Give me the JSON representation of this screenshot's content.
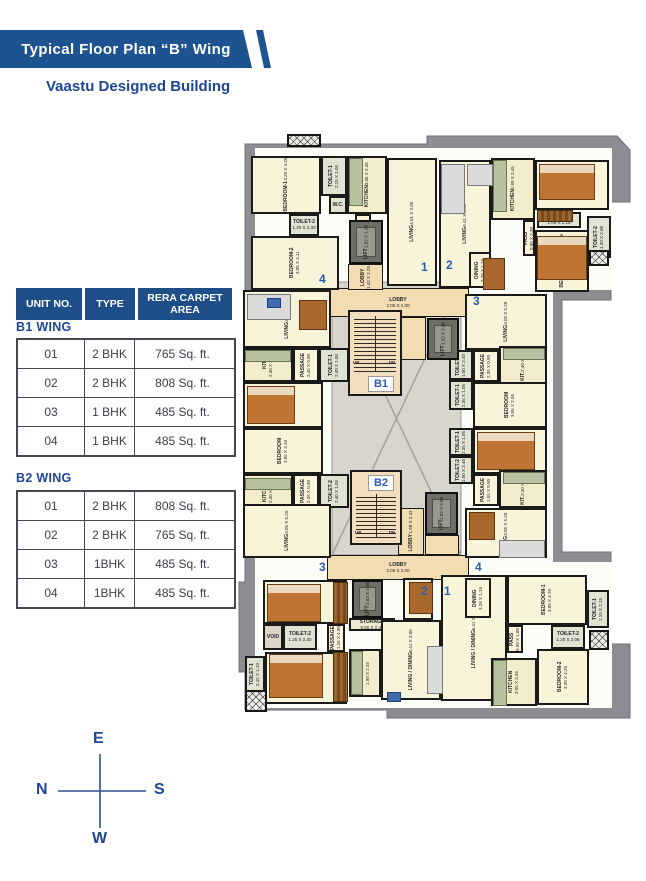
{
  "header": {
    "title": "Typical Floor Plan “B” Wing",
    "subtitle": "Vaastu Designed Building"
  },
  "table": {
    "columns": [
      "UNIT NO.",
      "TYPE",
      "RERA CARPET AREA"
    ],
    "sections": [
      {
        "name": "B1 WING",
        "rows": [
          [
            "01",
            "2 BHK",
            "765 Sq. ft."
          ],
          [
            "02",
            "2 BHK",
            "808 Sq. ft."
          ],
          [
            "03",
            "1 BHK",
            "485 Sq. ft."
          ],
          [
            "04",
            "1 BHK",
            "485 Sq. ft."
          ]
        ]
      },
      {
        "name": "B2 WING",
        "rows": [
          [
            "01",
            "2 BHK",
            "808 Sq. ft."
          ],
          [
            "02",
            "2 BHK",
            "765 Sq. ft."
          ],
          [
            "03",
            "1BHK",
            "485 Sq. ft."
          ],
          [
            "04",
            "1BHK",
            "485 Sq. ft."
          ]
        ]
      }
    ]
  },
  "compass": {
    "top": "E",
    "left": "N",
    "right": "S",
    "bottom": "W"
  },
  "colors": {
    "brand_blue": "#1d5391",
    "accent_blue": "#2a5db0",
    "wall": "#1a1a1a",
    "footprint_gray": "#8d8d92"
  },
  "plan": {
    "rooms": [
      {
        "n": "BEDROOM-1",
        "d": "3.20 X 4.25",
        "x": 14,
        "y": 24,
        "w": 70,
        "h": 58,
        "v": 1,
        "k": ""
      },
      {
        "n": "TOILET-1",
        "d": "2.15 X 1.05",
        "x": 84,
        "y": 24,
        "w": 26,
        "h": 40,
        "v": 1,
        "k": "toilet"
      },
      {
        "n": "KITCHEN",
        "d": "3.05 X 2.45",
        "x": 110,
        "y": 24,
        "w": 40,
        "h": 58,
        "v": 1,
        "k": "kitchen"
      },
      {
        "n": "W.C.",
        "d": "",
        "x": 92,
        "y": 64,
        "w": 18,
        "h": 18,
        "v": 0,
        "k": "toilet"
      },
      {
        "n": "TOILET-2",
        "d": "1.25 X 2.30",
        "x": 52,
        "y": 82,
        "w": 30,
        "h": 22,
        "v": 0,
        "k": "toilet"
      },
      {
        "n": "PASS",
        "d": "0.90 X 2.75",
        "x": 118,
        "y": 82,
        "w": 16,
        "h": 50,
        "v": 1,
        "k": ""
      },
      {
        "n": "BEDROOM-2",
        "d": "3.05 X 4.11",
        "x": 14,
        "y": 104,
        "w": 88,
        "h": 54,
        "v": 1,
        "k": ""
      },
      {
        "n": "LIVING",
        "d": "4.01 X 3.05",
        "x": 150,
        "y": 26,
        "w": 50,
        "h": 128,
        "v": 1,
        "k": ""
      },
      {
        "n": "LIVING",
        "d": "6.41 X 3.05",
        "x": 202,
        "y": 28,
        "w": 52,
        "h": 128,
        "v": 1,
        "k": ""
      },
      {
        "n": "KITCHEN",
        "d": "1.89 X 2.45",
        "x": 254,
        "y": 26,
        "w": 44,
        "h": 62,
        "v": 1,
        "k": "kitchen"
      },
      {
        "n": "BEDROOM-2",
        "d": "3.05 X 4.11",
        "x": 298,
        "y": 28,
        "w": 74,
        "h": 50,
        "v": 1,
        "k": ""
      },
      {
        "n": "PASS",
        "d": "0.90 X 2.30",
        "x": 286,
        "y": 88,
        "w": 12,
        "h": 36,
        "v": 1,
        "k": ""
      },
      {
        "n": "TOILET-1",
        "d": "1.05 X 2.15",
        "x": 300,
        "y": 80,
        "w": 44,
        "h": 16,
        "v": 0,
        "k": "toilet"
      },
      {
        "n": "BEDROOM-1",
        "d": "3.05 X 4.76",
        "x": 298,
        "y": 98,
        "w": 54,
        "h": 62,
        "v": 1,
        "k": ""
      },
      {
        "n": "TOILET-2",
        "d": "1.20 X 2.06",
        "x": 350,
        "y": 84,
        "w": 24,
        "h": 42,
        "v": 1,
        "k": "toilet"
      },
      {
        "n": "DINING",
        "d": "3.28 X 1.19",
        "x": 232,
        "y": 120,
        "w": 22,
        "h": 36,
        "v": 1,
        "k": ""
      },
      {
        "n": "LIVING",
        "d": "3.05 X 5.20",
        "x": 6,
        "y": 158,
        "w": 88,
        "h": 58,
        "v": 1,
        "k": ""
      },
      {
        "n": "KIT.",
        "d": "2.40 X 3.05",
        "x": 6,
        "y": 216,
        "w": 50,
        "h": 34,
        "v": 1,
        "k": "kitchen"
      },
      {
        "n": "PASSAGE",
        "d": "2.45 X 0.90",
        "x": 56,
        "y": 216,
        "w": 26,
        "h": 34,
        "v": 1,
        "k": ""
      },
      {
        "n": "TOILET-1",
        "d": "2.40 X 1.00",
        "x": 82,
        "y": 216,
        "w": 30,
        "h": 34,
        "v": 1,
        "k": "toilet"
      },
      {
        "n": "BEDROOM",
        "d": "3.05 X 3.00",
        "x": 6,
        "y": 250,
        "w": 80,
        "h": 46,
        "v": 1,
        "k": ""
      },
      {
        "n": "BEDROOM",
        "d": "3.05 X 3.10",
        "x": 6,
        "y": 296,
        "w": 80,
        "h": 46,
        "v": 1,
        "k": ""
      },
      {
        "n": "KITCHEN",
        "d": "2.40 X 2.90",
        "x": 6,
        "y": 342,
        "w": 50,
        "h": 34,
        "v": 1,
        "k": "kitchen"
      },
      {
        "n": "PASSAGE",
        "d": "2.35 X 0.90",
        "x": 56,
        "y": 342,
        "w": 26,
        "h": 34,
        "v": 1,
        "k": ""
      },
      {
        "n": "TOILET-2",
        "d": "2.40 X 1.05",
        "x": 82,
        "y": 342,
        "w": 30,
        "h": 34,
        "v": 1,
        "k": "toilet"
      },
      {
        "n": "LIVING",
        "d": "3.05 X 5.20",
        "x": 6,
        "y": 372,
        "w": 88,
        "h": 54,
        "v": 1,
        "k": ""
      },
      {
        "n": "LIVING",
        "d": "3.05 X 5.28",
        "x": 228,
        "y": 162,
        "w": 82,
        "h": 56,
        "v": 1,
        "k": ""
      },
      {
        "n": "TOILET-2",
        "d": "1.00 X 2.40",
        "x": 212,
        "y": 218,
        "w": 24,
        "h": 30,
        "v": 1,
        "k": "toilet"
      },
      {
        "n": "PASSAGE",
        "d": "2.35 X 0.90",
        "x": 236,
        "y": 218,
        "w": 26,
        "h": 32,
        "v": 1,
        "k": ""
      },
      {
        "n": "KIT.",
        "d": "2.40 X 3.05",
        "x": 262,
        "y": 214,
        "w": 48,
        "h": 38,
        "v": 1,
        "k": "kitchen"
      },
      {
        "n": "TOILET-1",
        "d": "2.35 X 1.05",
        "x": 212,
        "y": 248,
        "w": 24,
        "h": 30,
        "v": 1,
        "k": "toilet"
      },
      {
        "n": "BEDROOM",
        "d": "3.05 X 2.95",
        "x": 236,
        "y": 250,
        "w": 74,
        "h": 46,
        "v": 1,
        "k": ""
      },
      {
        "n": "TOILET-1",
        "d": "2.35 X 1.05",
        "x": 212,
        "y": 296,
        "w": 24,
        "h": 28,
        "v": 1,
        "k": "toilet"
      },
      {
        "n": "BEDROOM",
        "d": "3.05 X 2.95",
        "x": 236,
        "y": 296,
        "w": 74,
        "h": 46,
        "v": 1,
        "k": ""
      },
      {
        "n": "TOILET-2",
        "d": "1.00 X 2.40",
        "x": 212,
        "y": 324,
        "w": 24,
        "h": 28,
        "v": 1,
        "k": "toilet"
      },
      {
        "n": "PASSAGE",
        "d": "1.55 X 0.90",
        "x": 236,
        "y": 342,
        "w": 26,
        "h": 32,
        "v": 1,
        "k": ""
      },
      {
        "n": "KIT.",
        "d": "2.40 X 3.40",
        "x": 262,
        "y": 338,
        "w": 48,
        "h": 38,
        "v": 1,
        "k": "kitchen"
      },
      {
        "n": "LIVING",
        "d": "3.05 X 5.28",
        "x": 228,
        "y": 376,
        "w": 82,
        "h": 50,
        "v": 1,
        "k": ""
      },
      {
        "n": "BEDROOM-2",
        "d": "3.05 X 4.10",
        "x": 26,
        "y": 448,
        "w": 84,
        "h": 44,
        "v": 1,
        "k": ""
      },
      {
        "n": "VOID",
        "d": "",
        "x": 26,
        "y": 492,
        "w": 20,
        "h": 26,
        "v": 0,
        "k": "voidroom"
      },
      {
        "n": "TOILET-2",
        "d": "1.25 X 2.30",
        "x": 46,
        "y": 492,
        "w": 34,
        "h": 26,
        "v": 0,
        "k": "toilet"
      },
      {
        "n": "PASSAGE",
        "d": "1.25 X 4.90",
        "x": 90,
        "y": 492,
        "w": 18,
        "h": 28,
        "v": 1,
        "k": ""
      },
      {
        "n": "BEDROOM-1",
        "d": "3.20 X 4.25",
        "x": 28,
        "y": 520,
        "w": 82,
        "h": 52,
        "v": 1,
        "k": ""
      },
      {
        "n": "TOILET-1",
        "d": "2.15 X 1.10",
        "x": 8,
        "y": 524,
        "w": 20,
        "h": 36,
        "v": 1,
        "k": "toilet"
      },
      {
        "n": "STORAGE",
        "d": "0.55 X 2.45",
        "x": 112,
        "y": 486,
        "w": 46,
        "h": 13,
        "v": 0,
        "k": "storage"
      },
      {
        "n": "KITCHEN",
        "d": "1.90 X 2.45",
        "x": 112,
        "y": 517,
        "w": 32,
        "h": 48,
        "v": 1,
        "k": "kitchen"
      },
      {
        "n": "DINING",
        "d": "3.28 X 1.10",
        "x": 166,
        "y": 446,
        "w": 30,
        "h": 42,
        "v": 1,
        "k": ""
      },
      {
        "n": "LIVING / DINING",
        "d": "6.41 X 3.05",
        "x": 144,
        "y": 488,
        "w": 60,
        "h": 80,
        "v": 1,
        "k": ""
      },
      {
        "n": "LIVING / DINING",
        "d": "6.41 X 3.05",
        "x": 204,
        "y": 443,
        "w": 66,
        "h": 126,
        "v": 1,
        "k": ""
      },
      {
        "n": "DINING",
        "d": "3.28 X 1.19",
        "x": 228,
        "y": 446,
        "w": 26,
        "h": 40,
        "v": 1,
        "k": ""
      },
      {
        "n": "BEDROOM-1",
        "d": "3.05 X 4.70",
        "x": 270,
        "y": 443,
        "w": 80,
        "h": 50,
        "v": 1,
        "k": ""
      },
      {
        "n": "TOILET-1",
        "d": "1.10 X 2.15",
        "x": 350,
        "y": 458,
        "w": 22,
        "h": 38,
        "v": 1,
        "k": "toilet"
      },
      {
        "n": "TOILET-2",
        "d": "1.20 X 2.06",
        "x": 314,
        "y": 493,
        "w": 34,
        "h": 24,
        "v": 0,
        "k": "toilet"
      },
      {
        "n": "PASS",
        "d": "0.90 X 1.85",
        "x": 270,
        "y": 493,
        "w": 16,
        "h": 28,
        "v": 1,
        "k": ""
      },
      {
        "n": "KITCHEN",
        "d": "3.05 X 2.45",
        "x": 254,
        "y": 526,
        "w": 46,
        "h": 48,
        "v": 1,
        "k": "kitchen"
      },
      {
        "n": "BEDROOM-2",
        "d": "3.20 X 4.25",
        "x": 300,
        "y": 517,
        "w": 52,
        "h": 56,
        "v": 1,
        "k": ""
      }
    ],
    "lobbies": [
      {
        "n": "LOBBY",
        "d": "2.06 X 2.00",
        "x": 90,
        "y": 156,
        "w": 142,
        "h": 29,
        "v": 0
      },
      {
        "n": "LOBBY",
        "d": "1.42 X 2.29",
        "x": 111,
        "y": 132,
        "w": 35,
        "h": 26,
        "v": 1
      },
      {
        "n": "",
        "d": "",
        "x": 161,
        "y": 185,
        "w": 28,
        "h": 43,
        "v": 0
      },
      {
        "n": "LOBBY",
        "d": "1.98 X 2.43",
        "x": 161,
        "y": 376,
        "w": 26,
        "h": 47,
        "v": 1
      },
      {
        "n": "",
        "d": "",
        "x": 188,
        "y": 403,
        "w": 34,
        "h": 20,
        "v": 0
      },
      {
        "n": "LOBBY",
        "d": "2.06 X 2.00",
        "x": 90,
        "y": 423,
        "w": 142,
        "h": 25,
        "v": 0
      }
    ],
    "lifts": [
      {
        "n": "LIFT",
        "d": "1.82 X 1.98",
        "x": 112,
        "y": 88,
        "w": 34,
        "h": 44
      },
      {
        "n": "LIFT",
        "d": "1.92 X 2.06",
        "x": 190,
        "y": 186,
        "w": 32,
        "h": 42
      },
      {
        "n": "LIFT",
        "d": "1.92 X 2.06",
        "x": 188,
        "y": 360,
        "w": 33,
        "h": 43
      },
      {
        "n": "LIFT",
        "d": "2.03 X 2.06",
        "x": 115,
        "y": 448,
        "w": 31,
        "h": 38
      }
    ],
    "stairs": [
      {
        "x": 111,
        "y": 178,
        "w": 54,
        "h": 86,
        "steps_top": 4,
        "steps_h": 56,
        "chip": "B1",
        "cx": 131,
        "cy": 244,
        "up": "UP",
        "dn": "DN",
        "ux": 116,
        "uy": 228,
        "dx": 146,
        "dy": 228
      },
      {
        "x": 113,
        "y": 338,
        "w": 52,
        "h": 75,
        "steps_top": 22,
        "steps_h": 44,
        "chip": "B2",
        "cx": 131,
        "cy": 343,
        "up": "UP",
        "dn": "DN",
        "ux": 118,
        "uy": 398,
        "dx": 146,
        "dy": 398
      }
    ],
    "markers": [
      {
        "t": "1",
        "x": 184,
        "y": 128
      },
      {
        "t": "2",
        "x": 209,
        "y": 126
      },
      {
        "t": "4",
        "x": 82,
        "y": 140
      },
      {
        "t": "3",
        "x": 236,
        "y": 162
      },
      {
        "t": "3",
        "x": 82,
        "y": 428
      },
      {
        "t": "4",
        "x": 238,
        "y": 428
      },
      {
        "t": "2",
        "x": 184,
        "y": 452
      },
      {
        "t": "1",
        "x": 207,
        "y": 452
      }
    ],
    "furniture": [
      {
        "k": "bed",
        "x": 302,
        "y": 32,
        "w": 54,
        "h": 34
      },
      {
        "k": "bed",
        "x": 300,
        "y": 104,
        "w": 48,
        "h": 42
      },
      {
        "k": "bed",
        "x": 10,
        "y": 254,
        "w": 46,
        "h": 36
      },
      {
        "k": "bed",
        "x": 240,
        "y": 300,
        "w": 56,
        "h": 36
      },
      {
        "k": "bed",
        "x": 30,
        "y": 452,
        "w": 52,
        "h": 36
      },
      {
        "k": "bed",
        "x": 32,
        "y": 522,
        "w": 52,
        "h": 42
      },
      {
        "k": "sofa",
        "x": 204,
        "y": 32,
        "w": 22,
        "h": 48
      },
      {
        "k": "sofa",
        "x": 230,
        "y": 32,
        "w": 24,
        "h": 20
      },
      {
        "k": "sofa",
        "x": 10,
        "y": 162,
        "w": 42,
        "h": 24
      },
      {
        "k": "sofa",
        "x": 262,
        "y": 408,
        "w": 44,
        "h": 16
      },
      {
        "k": "sofa",
        "x": 190,
        "y": 514,
        "w": 14,
        "h": 46
      },
      {
        "k": "table",
        "x": 62,
        "y": 168,
        "w": 26,
        "h": 28
      },
      {
        "k": "table",
        "x": 232,
        "y": 380,
        "w": 24,
        "h": 26
      },
      {
        "k": "table",
        "x": 172,
        "y": 450,
        "w": 22,
        "h": 30
      },
      {
        "k": "table",
        "x": 246,
        "y": 126,
        "w": 20,
        "h": 30
      },
      {
        "k": "counter",
        "x": 112,
        "y": 26,
        "w": 12,
        "h": 46
      },
      {
        "k": "counter",
        "x": 256,
        "y": 28,
        "w": 12,
        "h": 50
      },
      {
        "k": "counter",
        "x": 8,
        "y": 218,
        "w": 44,
        "h": 10
      },
      {
        "k": "counter",
        "x": 8,
        "y": 346,
        "w": 44,
        "h": 10
      },
      {
        "k": "counter",
        "x": 266,
        "y": 216,
        "w": 40,
        "h": 10
      },
      {
        "k": "counter",
        "x": 266,
        "y": 340,
        "w": 40,
        "h": 10
      },
      {
        "k": "counter",
        "x": 114,
        "y": 519,
        "w": 10,
        "h": 42
      },
      {
        "k": "counter",
        "x": 256,
        "y": 528,
        "w": 12,
        "h": 44
      },
      {
        "k": "wardrobe",
        "x": 96,
        "y": 450,
        "w": 13,
        "h": 40
      },
      {
        "k": "wardrobe",
        "x": 96,
        "y": 520,
        "w": 13,
        "h": 48
      },
      {
        "k": "wardrobe",
        "x": 300,
        "y": 78,
        "w": 34,
        "h": 10
      },
      {
        "k": "tv",
        "x": 30,
        "y": 166,
        "w": 12,
        "h": 8
      },
      {
        "k": "tv",
        "x": 150,
        "y": 560,
        "w": 12,
        "h": 8
      }
    ],
    "hatches": [
      {
        "x": 50,
        "y": 2,
        "w": 34,
        "h": 13
      },
      {
        "x": 8,
        "y": 558,
        "w": 22,
        "h": 22
      },
      {
        "x": 352,
        "y": 498,
        "w": 20,
        "h": 20
      },
      {
        "x": 352,
        "y": 118,
        "w": 20,
        "h": 16
      }
    ]
  }
}
